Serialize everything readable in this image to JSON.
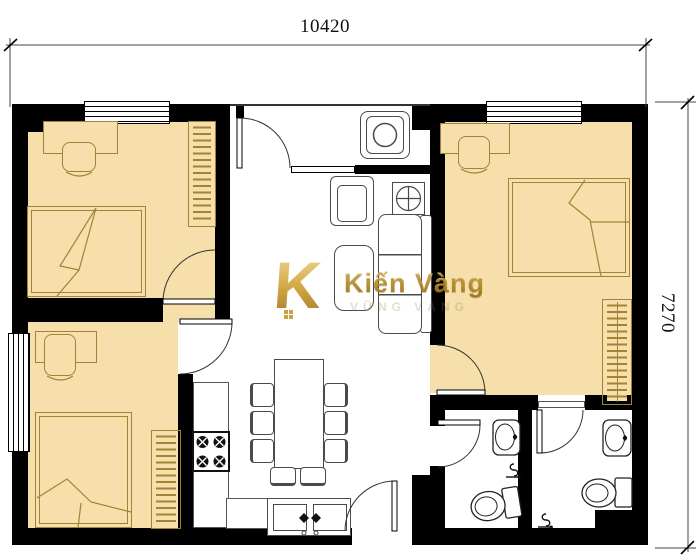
{
  "dimensions": {
    "width_label": "10420",
    "height_label": "7270"
  },
  "watermark": {
    "logo_letter": "K",
    "brand": "Kiến Vàng",
    "tagline": "VỮNG VÀNG"
  },
  "colors": {
    "wall": "#000000",
    "floor": "#f6dfab",
    "furniture-outline": "#a08336",
    "line": "#3c3c3c",
    "fixture": "#222222",
    "gold": "#c79a30"
  }
}
